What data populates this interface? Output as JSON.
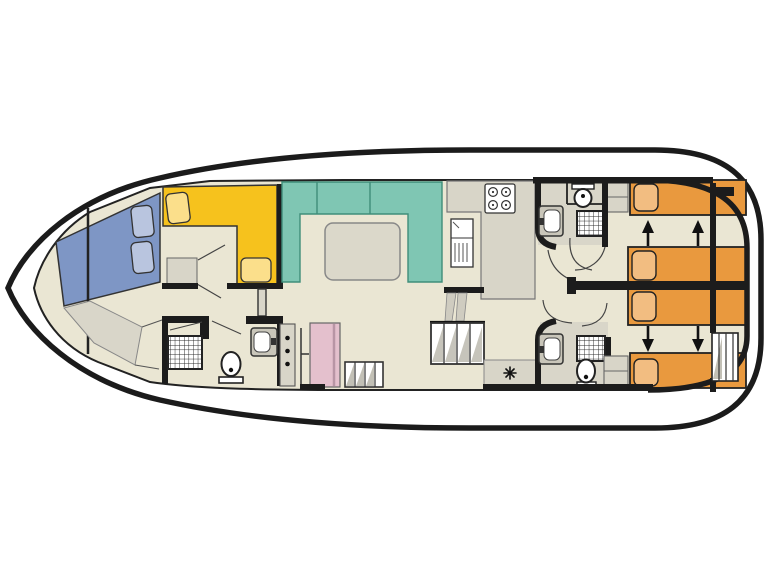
{
  "diagram": {
    "type": "boat-floorplan",
    "description": "top-down deck plan of a motor cruiser houseboat, bow at left and stern at right",
    "rooms": [
      {
        "name": "bow-sundeck",
        "features": [
          "sun-pad",
          "two-cushions"
        ]
      },
      {
        "name": "forward-cabin-dinette",
        "features": [
          "l-shaped-bench",
          "two-cushions",
          "side-table"
        ]
      },
      {
        "name": "forward-bathroom",
        "features": [
          "shower",
          "toilet",
          "washbasin"
        ]
      },
      {
        "name": "saloon",
        "features": [
          "u-shaped-sofa",
          "table"
        ]
      },
      {
        "name": "galley",
        "features": [
          "stove-4-burners",
          "fridge",
          "counter"
        ]
      },
      {
        "name": "mid-stairs",
        "features": [
          "staircase",
          "small-steps",
          "wardrobe",
          "cupboard"
        ]
      },
      {
        "name": "helm",
        "features": [
          "star-marker"
        ]
      },
      {
        "name": "aft-bathroom-top",
        "features": [
          "toilet",
          "shower",
          "washbasin"
        ]
      },
      {
        "name": "aft-bathroom-bottom",
        "features": [
          "washbasin",
          "shower",
          "toilet"
        ]
      },
      {
        "name": "aft-cabin-top",
        "features": [
          "single-bed",
          "sliding-double-bed",
          "cupboard",
          "arrows-up"
        ]
      },
      {
        "name": "aft-cabin-bottom",
        "features": [
          "sliding-double-bed",
          "single-bed",
          "cupboard",
          "arrows-down"
        ]
      },
      {
        "name": "stern",
        "features": [
          "steps"
        ]
      }
    ]
  },
  "colors": {
    "hull_line": "#1b1b1b",
    "wall": "#1c1c1c",
    "deck_white": "#ffffff",
    "floor": "#eae6d3",
    "sunpad_blue": "#7e96c5",
    "cushion_blue": "#b9c5df",
    "dinette_yellow": "#f6c21d",
    "cushion_yellow": "#fbdf8b",
    "saloon_teal": "#7fc6b3",
    "saloon_teal_edge": "#3f8d7a",
    "bed_orange": "#e9993e",
    "pillow_orange": "#f2bd81",
    "wardrobe_pink": "#e4c0cd",
    "furniture_grey": "#d8d5c8",
    "shade_grey": "#b3b0a4",
    "bath_floor_grey": "#d9d6c9",
    "table_grey": "#dbd8ca"
  }
}
